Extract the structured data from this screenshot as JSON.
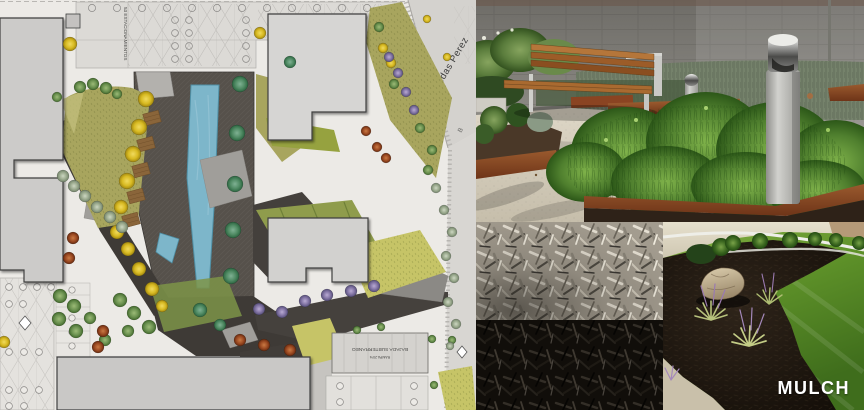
{
  "plan": {
    "labels": {
      "parking_count": "53 ESTACIONAMIENTOS",
      "street_name": "Leonidas Perez",
      "street_letter": "B",
      "ramp": "RAMPA 20%",
      "basement": "BAJADA SUBTERRANEO"
    },
    "colors": {
      "pool": "#7db6ca",
      "lawn_olive": "#a8a55e",
      "path_dark": "#3e3a36",
      "building_gray": "#cccbc9"
    }
  },
  "photos": {
    "mulch_label": "MULCH",
    "colors": {
      "corten_steel": "#8a4a26",
      "black_mulch": "#15110c",
      "gray_mulch": "#a39c8f",
      "caption_white": "#ffffff"
    }
  }
}
